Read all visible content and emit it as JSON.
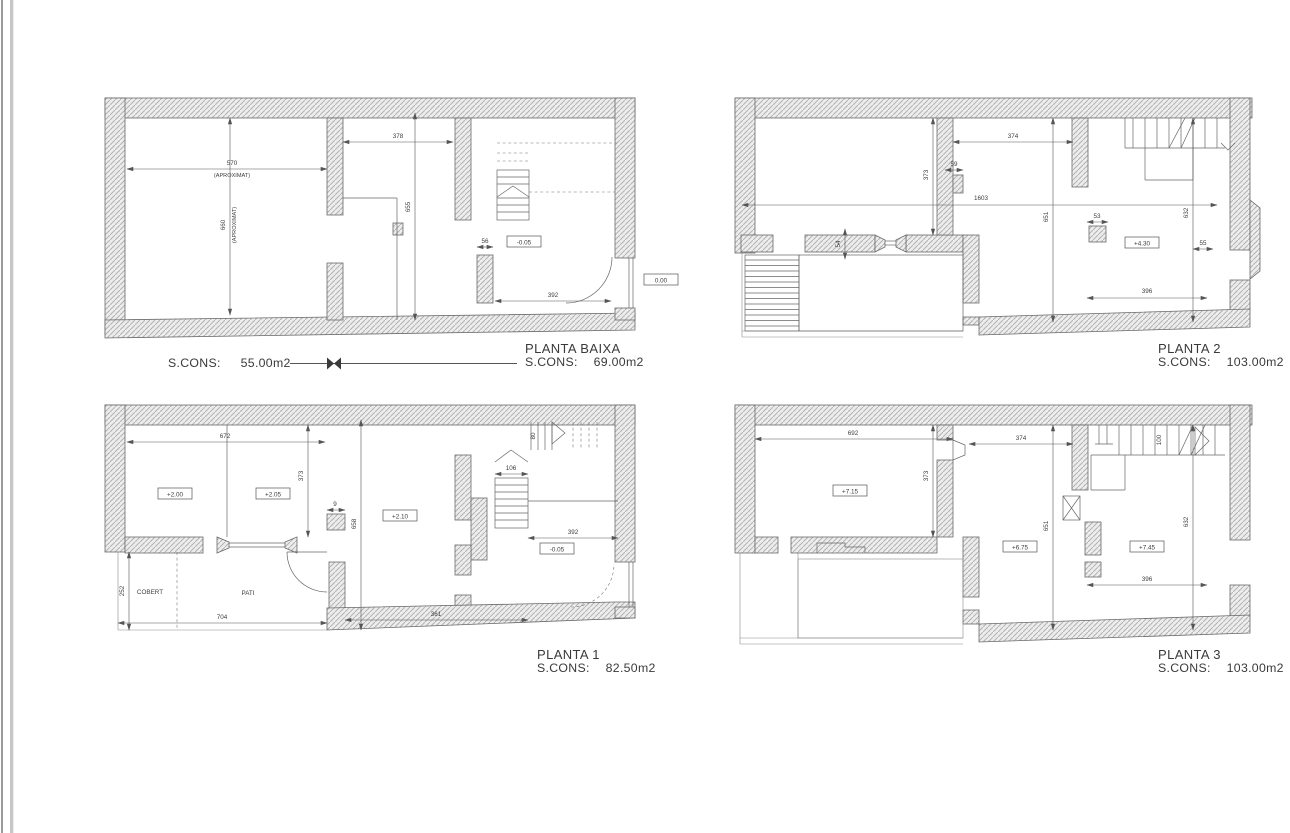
{
  "plans": {
    "baixa": {
      "title": "PLANTA BAIXA",
      "scons_label": "S.CONS:",
      "scons_value": "69.00m2",
      "scons_left_label": "S.CONS:",
      "scons_left_value": "55.00m2",
      "dims": {
        "d570": "570",
        "aprox1": "(APROXIMAT)",
        "d660": "660",
        "aprox2": "(APROXIMAT)",
        "d378": "378",
        "d655": "655",
        "d56": "56",
        "d392": "392"
      },
      "levels": {
        "m005": "-0.05",
        "zero": "0.00"
      }
    },
    "p1": {
      "title": "PLANTA 1",
      "scons_label": "S.CONS:",
      "scons_value": "82.50m2",
      "dims": {
        "d672": "672",
        "d373": "373",
        "d9": "9",
        "d658": "658",
        "d106": "106",
        "d80": "80",
        "d392": "392",
        "d252": "252",
        "d704": "704",
        "d361": "361"
      },
      "levels": {
        "p200": "+2.00",
        "p205": "+2.05",
        "p210": "+2.10",
        "m005": "-0.05"
      },
      "rooms": {
        "cobert": "COBERT",
        "pati": "PATI"
      }
    },
    "p2": {
      "title": "PLANTA 2",
      "scons_label": "S.CONS:",
      "scons_value": "103.00m2",
      "dims": {
        "d374": "374",
        "d59": "59",
        "d373": "373",
        "d1603": "1603",
        "d651": "651",
        "d632": "632",
        "d54": "54",
        "d53": "53",
        "d55": "55",
        "d396": "396"
      },
      "levels": {
        "p430": "+4.30"
      }
    },
    "p3": {
      "title": "PLANTA 3",
      "scons_label": "S.CONS:",
      "scons_value": "103.00m2",
      "dims": {
        "d692": "692",
        "d373": "373",
        "d374": "374",
        "d651": "651",
        "d632": "632",
        "d396": "396",
        "d100": "100"
      },
      "levels": {
        "p715": "+7.15",
        "p675": "+6.75",
        "p745": "+7.45"
      }
    }
  }
}
